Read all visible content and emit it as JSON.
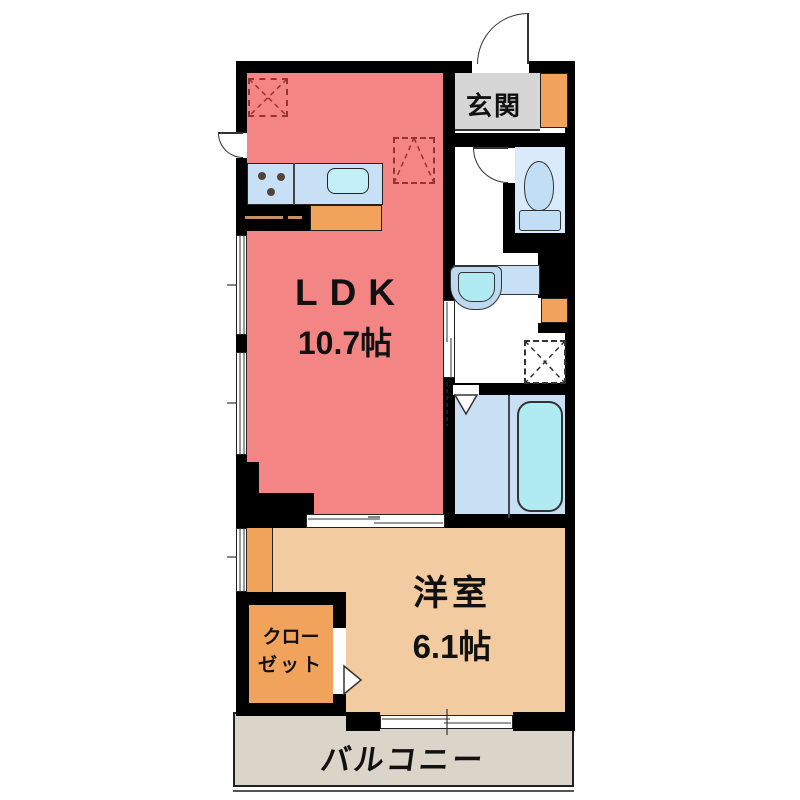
{
  "plan_title": "apartment-floor-plan-1LDK",
  "rooms": {
    "ldk": {
      "label": "LDK",
      "area": "10.7帖"
    },
    "western": {
      "label": "洋室",
      "area": "6.1帖"
    },
    "entrance": {
      "label": "玄関"
    },
    "closet": {
      "line1": "クロー",
      "line2": "ゼット"
    },
    "balcony": {
      "label": "バルコニー"
    }
  },
  "fixtures": {
    "kitchen_counter": "kitchen-counter",
    "gas_stove": "gas-stove-3-burners",
    "kitchen_sink": "kitchen-sink",
    "toilet": "toilet",
    "washbasin": "washbasin",
    "bathtub": "bathtub",
    "washing_machine_space": "washing-machine-space-dashed",
    "refrigerator_space": "refrigerator-space-dashed",
    "storage_box": "storage-cabinet"
  },
  "colors": {
    "wall": "#000000",
    "ldk_fill": "#F38585",
    "western_fill": "#F2CBA0",
    "accent_orange": "#F1A35B",
    "balcony_fill": "#DBD4C9",
    "entrance_fill": "#D6D6D6",
    "counter_blue": "#C7E0F5",
    "bath_fill": "#C9DFF3",
    "toilet_room_fill": "#D9EBFA",
    "fixture_cyan": "#B0EAF2",
    "dashed_marker": "#993333"
  }
}
